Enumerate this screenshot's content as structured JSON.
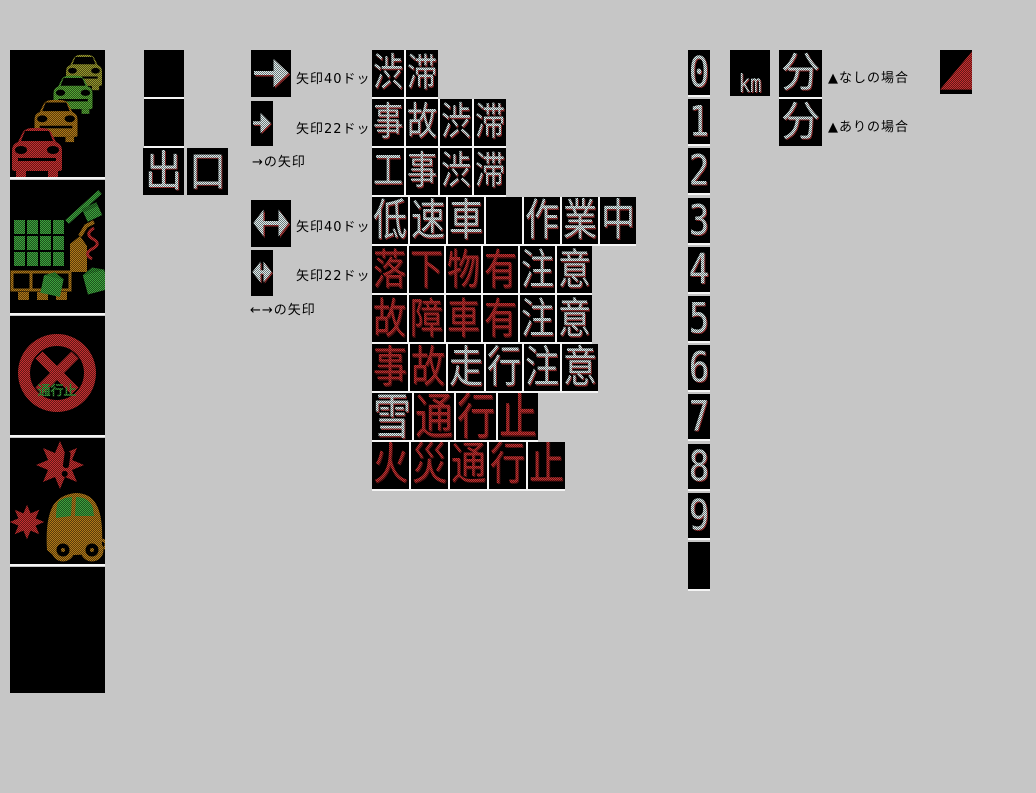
{
  "colors": {
    "background": "#c6c6c6",
    "led_white": "#dcecec",
    "led_red": "#c52f2f",
    "led_green": "#3da23d",
    "led_amber": "#b07818",
    "led_olive": "#97972d"
  },
  "pictogram_column": {
    "panels": [
      {
        "id": "traffic-jam"
      },
      {
        "id": "falling-cargo"
      },
      {
        "id": "road-closed",
        "text": "通行止"
      },
      {
        "id": "accident"
      },
      {
        "id": "blank"
      }
    ]
  },
  "exit_sign": {
    "blank_cells": 2,
    "chars": [
      "出",
      "口"
    ]
  },
  "arrow_section": {
    "right": {
      "label_40": "矢印40ドット",
      "label_22": "矢印22ドット",
      "caption": "→の矢印"
    },
    "double": {
      "label_40": "矢印40ドット",
      "label_22": "矢印22ドット",
      "caption": "←→の矢印"
    }
  },
  "led_messages": [
    {
      "text": "渋滞",
      "segments": [
        {
          "text": "渋滞",
          "color": "white"
        }
      ]
    },
    {
      "text": "事故渋滞",
      "segments": [
        {
          "text": "事故渋滞",
          "color": "white"
        }
      ]
    },
    {
      "text": "工事渋滞",
      "segments": [
        {
          "text": "工事渋滞",
          "color": "white"
        }
      ]
    },
    {
      "text": "低速車 作業中",
      "segments": [
        {
          "text": "低速車",
          "color": "white"
        },
        {
          "text": "",
          "cells": 1,
          "color": "blank"
        },
        {
          "text": "作業中",
          "color": "white"
        }
      ]
    },
    {
      "text": "落下物有注意",
      "segments": [
        {
          "text": "落下物有",
          "color": "red"
        },
        {
          "text": "注意",
          "color": "white"
        }
      ]
    },
    {
      "text": "故障車有注意",
      "segments": [
        {
          "text": "故障車有",
          "color": "red"
        },
        {
          "text": "注意",
          "color": "white"
        }
      ]
    },
    {
      "text": "事故走行注意",
      "segments": [
        {
          "text": "事故",
          "color": "red"
        },
        {
          "text": "走行注意",
          "color": "white"
        }
      ]
    },
    {
      "text": "雪通行止",
      "segments": [
        {
          "text": "雪",
          "color": "white"
        },
        {
          "text": "通行止",
          "color": "red"
        }
      ]
    },
    {
      "text": "火災通行止",
      "segments": [
        {
          "text": "火災通行止",
          "color": "red"
        }
      ]
    }
  ],
  "digit_column": {
    "digits": [
      "0",
      "1",
      "2",
      "3",
      "4",
      "5",
      "6",
      "7",
      "8",
      "9"
    ],
    "trailing_blank_cell": true
  },
  "units": {
    "km": "km",
    "minutes_top": "分",
    "minutes_bottom": "分"
  },
  "captions": {
    "triangle_absent": "▲なしの場合",
    "triangle_present": "▲ありの場合"
  }
}
